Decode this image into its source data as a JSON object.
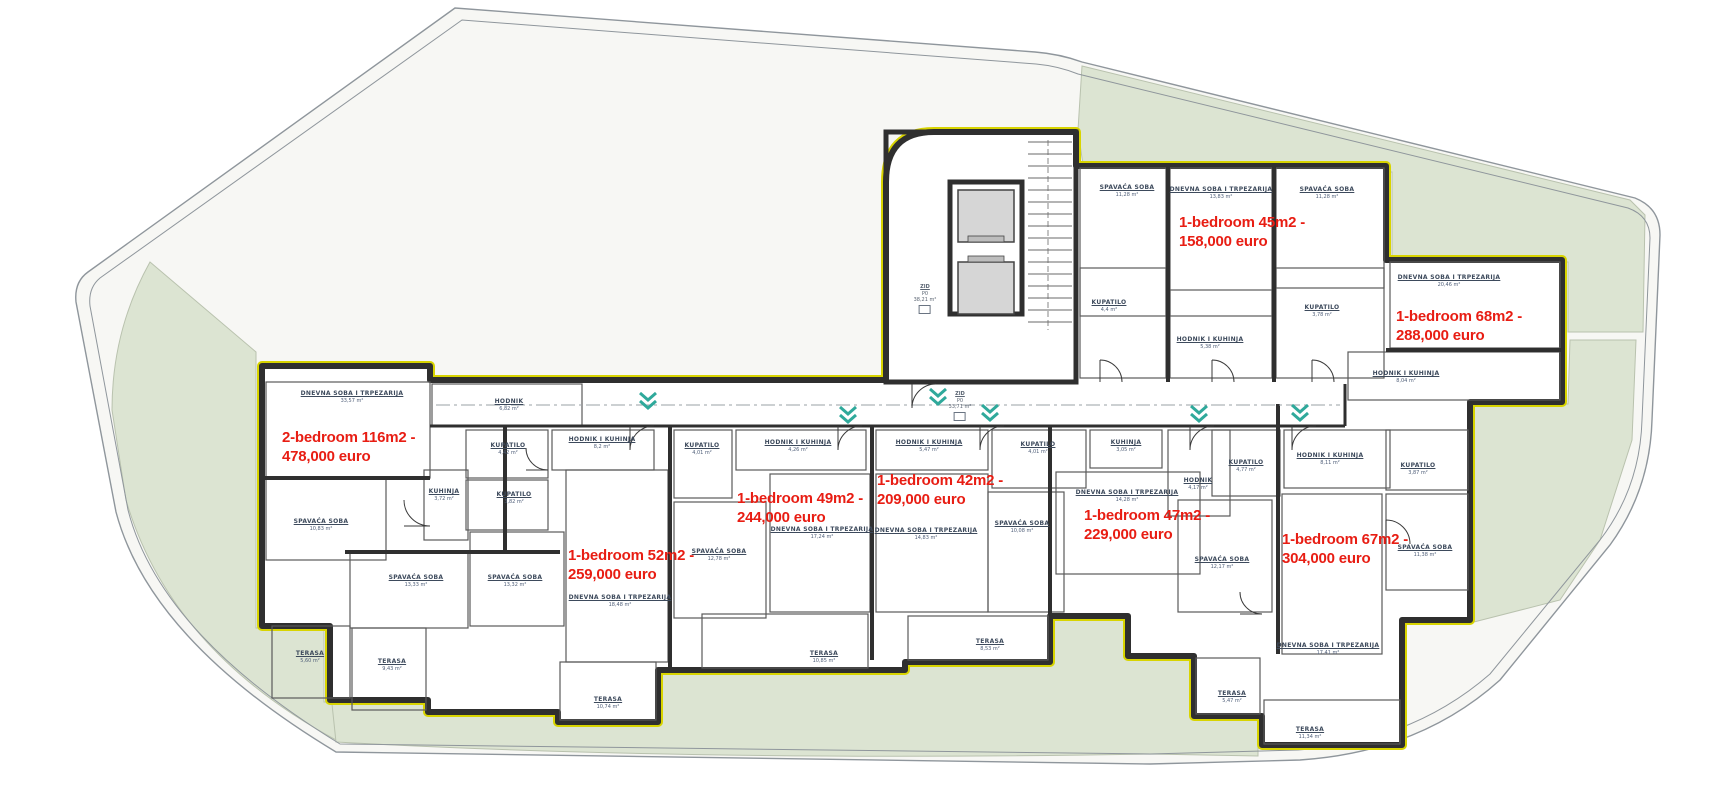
{
  "plan": {
    "colors": {
      "price_red": "#e81d13",
      "green_area": "#dce4d2",
      "wall_dark": "#2f2f2f",
      "insulation_yellow": "#d8d400",
      "label_blue": "#3d4a5c",
      "marker_teal": "#2fa99b",
      "site_line_gray": "#8f969c"
    },
    "apartments": [
      {
        "line1": "2-bedroom 116m2 -",
        "line2": "478,000 euro",
        "x": 282,
        "y": 428
      },
      {
        "line1": "1-bedroom 52m2 -",
        "line2": "259,000 euro",
        "x": 568,
        "y": 546
      },
      {
        "line1": "1-bedroom 49m2 -",
        "line2": "244,000 euro",
        "x": 737,
        "y": 489
      },
      {
        "line1": "1-bedroom 42m2 -",
        "line2": "209,000 euro",
        "x": 877,
        "y": 471
      },
      {
        "line1": "1-bedroom 47m2 -",
        "line2": "229,000 euro",
        "x": 1084,
        "y": 506
      },
      {
        "line1": "1-bedroom 67m2 -",
        "line2": "304,000 euro",
        "x": 1282,
        "y": 530
      },
      {
        "line1": "1-bedroom 45m2 -",
        "line2": "158,000 euro",
        "x": 1179,
        "y": 213
      },
      {
        "line1": "1-bedroom 68m2 -",
        "line2": "288,000 euro",
        "x": 1396,
        "y": 307
      }
    ],
    "rooms": [
      {
        "name": "DNEVNA SOBA I TRPEZARIJA",
        "area": "33,57 m²",
        "lx": 352,
        "ly": 394,
        "rx": 266,
        "ry": 382,
        "rw": 164,
        "rh": 96
      },
      {
        "name": "SPAVAĆA SOBA",
        "area": "10,83 m²",
        "lx": 321,
        "ly": 522,
        "rx": 266,
        "ry": 478,
        "rw": 120,
        "rh": 82
      },
      {
        "name": "KUHINJA",
        "area": "3,72 m²",
        "lx": 444,
        "ly": 492,
        "rx": 424,
        "ry": 470,
        "rw": 44,
        "rh": 70
      },
      {
        "name": "SPAVAĆA SOBA",
        "area": "13,33 m²",
        "lx": 416,
        "ly": 578,
        "rx": 350,
        "ry": 552,
        "rw": 118,
        "rh": 76
      },
      {
        "name": "TERASA",
        "area": "5,60 m²",
        "lx": 310,
        "ly": 654,
        "rx": 272,
        "ry": 626,
        "rw": 78,
        "rh": 72
      },
      {
        "name": "TERASA",
        "area": "9,43 m²",
        "lx": 392,
        "ly": 662,
        "rx": 352,
        "ry": 628,
        "rw": 74,
        "rh": 82
      },
      {
        "name": "HODNIK",
        "area": "6,82 m²",
        "lx": 509,
        "ly": 402,
        "rx": 432,
        "ry": 384,
        "rw": 150,
        "rh": 42
      },
      {
        "name": "KUPATILO",
        "area": "4,42 m²",
        "lx": 508,
        "ly": 446,
        "rx": 466,
        "ry": 430,
        "rw": 82,
        "rh": 48
      },
      {
        "name": "KUPATILO",
        "area": "3,82 m²",
        "lx": 514,
        "ly": 495,
        "rx": 466,
        "ry": 480,
        "rw": 82,
        "rh": 50
      },
      {
        "name": "HODNIK I KUHINJA",
        "area": "8,2 m²",
        "lx": 602,
        "ly": 440,
        "rx": 552,
        "ry": 430,
        "rw": 102,
        "rh": 40
      },
      {
        "name": "SPAVAĆA SOBA",
        "area": "13,32 m²",
        "lx": 515,
        "ly": 578,
        "rx": 470,
        "ry": 532,
        "rw": 94,
        "rh": 94
      },
      {
        "name": "DNEVNA SOBA I TRPEZARIJA",
        "area": "18,48 m²",
        "lx": 620,
        "ly": 598,
        "rx": 566,
        "ry": 470,
        "rw": 102,
        "rh": 192
      },
      {
        "name": "TERASA",
        "area": "10,74 m²",
        "lx": 608,
        "ly": 700,
        "rx": 560,
        "ry": 662,
        "rw": 96,
        "rh": 58
      },
      {
        "name": "KUPATILO",
        "area": "4,01 m²",
        "lx": 702,
        "ly": 446,
        "rx": 674,
        "ry": 430,
        "rw": 58,
        "rh": 68
      },
      {
        "name": "HODNIK I KUHINJA",
        "area": "4,26 m²",
        "lx": 798,
        "ly": 443,
        "rx": 736,
        "ry": 430,
        "rw": 130,
        "rh": 40
      },
      {
        "name": "SPAVAĆA SOBA",
        "area": "12,78 m²",
        "lx": 719,
        "ly": 552,
        "rx": 674,
        "ry": 502,
        "rw": 92,
        "rh": 116
      },
      {
        "name": "DNEVNA SOBA I TRPEZARIJA",
        "area": "17,24 m²",
        "lx": 822,
        "ly": 530,
        "rx": 770,
        "ry": 474,
        "rw": 100,
        "rh": 138
      },
      {
        "name": "TERASA",
        "area": "10,85 m²",
        "lx": 824,
        "ly": 654,
        "rx": 702,
        "ry": 614,
        "rw": 166,
        "rh": 54
      },
      {
        "name": "HODNIK I KUHINJA",
        "area": "5,47 m²",
        "lx": 929,
        "ly": 443,
        "rx": 876,
        "ry": 430,
        "rw": 112,
        "rh": 40
      },
      {
        "name": "DNEVNA SOBA I TRPEZARIJA",
        "area": "14,83 m²",
        "lx": 926,
        "ly": 531,
        "rx": 876,
        "ry": 474,
        "rw": 112,
        "rh": 138
      },
      {
        "name": "KUPATILO",
        "area": "4,01 m²",
        "lx": 1038,
        "ly": 445,
        "rx": 992,
        "ry": 430,
        "rw": 94,
        "rh": 58
      },
      {
        "name": "SPAVAĆA SOBA",
        "area": "10,08 m²",
        "lx": 1022,
        "ly": 524,
        "rx": 988,
        "ry": 492,
        "rw": 76,
        "rh": 120
      },
      {
        "name": "TERASA",
        "area": "8,53 m²",
        "lx": 990,
        "ly": 642,
        "rx": 908,
        "ry": 616,
        "rw": 140,
        "rh": 44
      },
      {
        "name": "KUHINJA",
        "area": "3,05 m²",
        "lx": 1126,
        "ly": 443,
        "rx": 1090,
        "ry": 430,
        "rw": 72,
        "rh": 38
      },
      {
        "name": "DNEVNA SOBA I TRPEZARIJA",
        "area": "14,28 m²",
        "lx": 1127,
        "ly": 493,
        "rx": 1056,
        "ry": 472,
        "rw": 144,
        "rh": 102
      },
      {
        "name": "HODNIK",
        "area": "4,17 m²",
        "lx": 1198,
        "ly": 481,
        "rx": 1168,
        "ry": 430,
        "rw": 62,
        "rh": 86
      },
      {
        "name": "KUPATILO",
        "area": "4,77 m²",
        "lx": 1246,
        "ly": 463,
        "rx": 1212,
        "ry": 430,
        "rw": 68,
        "rh": 66
      },
      {
        "name": "SPAVAĆA SOBA",
        "area": "12,17 m²",
        "lx": 1222,
        "ly": 560,
        "rx": 1178,
        "ry": 500,
        "rw": 94,
        "rh": 112
      },
      {
        "name": "TERASA",
        "area": "5,47 m²",
        "lx": 1232,
        "ly": 694,
        "rx": 1196,
        "ry": 658,
        "rw": 64,
        "rh": 56
      },
      {
        "name": "HODNIK I KUHINJA",
        "area": "8,11 m²",
        "lx": 1330,
        "ly": 456,
        "rx": 1284,
        "ry": 430,
        "rw": 106,
        "rh": 58
      },
      {
        "name": "KUPATILO",
        "area": "3,87 m²",
        "lx": 1418,
        "ly": 466,
        "rx": 1386,
        "ry": 430,
        "rw": 82,
        "rh": 60
      },
      {
        "name": "SPAVAĆA SOBA",
        "area": "11,38 m²",
        "lx": 1425,
        "ly": 548,
        "rx": 1386,
        "ry": 494,
        "rw": 82,
        "rh": 96
      },
      {
        "name": "DNEVNA SOBA I TRPEZARIJA",
        "area": "17,41 m²",
        "lx": 1328,
        "ly": 646,
        "rx": 1282,
        "ry": 494,
        "rw": 100,
        "rh": 160
      },
      {
        "name": "TERASA",
        "area": "11,34 m²",
        "lx": 1310,
        "ly": 730,
        "rx": 1264,
        "ry": 700,
        "rw": 136,
        "rh": 44
      },
      {
        "name": "SPAVAĆA SOBA",
        "area": "11,28 m²",
        "lx": 1127,
        "ly": 188,
        "rx": 1080,
        "ry": 168,
        "rw": 86,
        "rh": 148
      },
      {
        "name": "DNEVNA SOBA I TRPEZARIJA",
        "area": "13,83 m²",
        "lx": 1221,
        "ly": 190,
        "rx": 1170,
        "ry": 168,
        "rw": 102,
        "rh": 148
      },
      {
        "name": "SPAVAĆA SOBA",
        "area": "11,28 m²",
        "lx": 1327,
        "ly": 190,
        "rx": 1276,
        "ry": 168,
        "rw": 108,
        "rh": 120
      },
      {
        "name": "KUPATILO",
        "area": "4,4 m²",
        "lx": 1109,
        "ly": 303,
        "rx": 1080,
        "ry": 268,
        "rw": 86,
        "rh": 110
      },
      {
        "name": "HODNIK I KUHINJA",
        "area": "5,38 m²",
        "lx": 1210,
        "ly": 340,
        "rx": 1170,
        "ry": 290,
        "rw": 102,
        "rh": 88
      },
      {
        "name": "KUPATILO",
        "area": "3,78 m²",
        "lx": 1322,
        "ly": 308,
        "rx": 1276,
        "ry": 268,
        "rw": 108,
        "rh": 110
      },
      {
        "name": "DNEVNA SOBA I TRPEZARIJA",
        "area": "20,46 m²",
        "lx": 1449,
        "ly": 278,
        "rx": 1390,
        "ry": 262,
        "rw": 170,
        "rh": 86
      },
      {
        "name": "HODNIK I KUHINJA",
        "area": "8,04 m²",
        "lx": 1406,
        "ly": 374,
        "rx": 1348,
        "ry": 352,
        "rw": 212,
        "rh": 48
      }
    ],
    "zone_labels": [
      {
        "lines": [
          "ZID",
          "P0",
          "38,21 m²"
        ],
        "x": 925,
        "y": 284
      },
      {
        "lines": [
          "ZID",
          "P0",
          "33,71 m²"
        ],
        "x": 960,
        "y": 391
      }
    ],
    "entry_markers": [
      {
        "x": 648,
        "y": 404
      },
      {
        "x": 848,
        "y": 418
      },
      {
        "x": 990,
        "y": 416
      },
      {
        "x": 1199,
        "y": 417
      },
      {
        "x": 1300,
        "y": 416
      },
      {
        "x": 938,
        "y": 400
      }
    ]
  }
}
